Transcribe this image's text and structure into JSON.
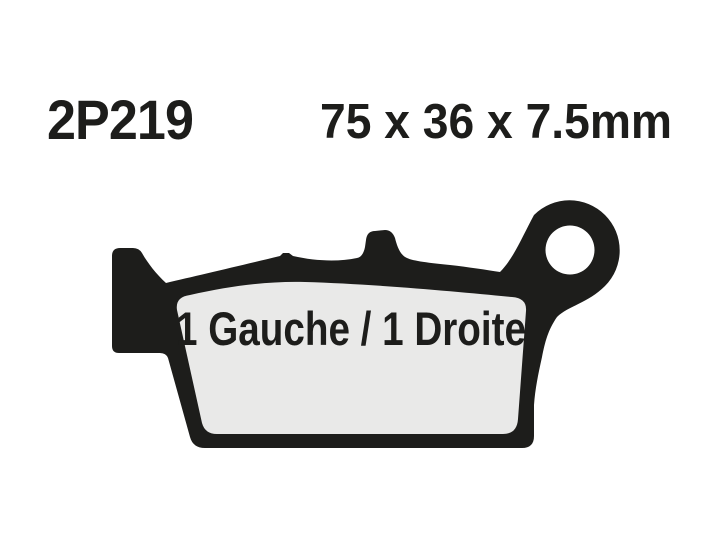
{
  "page": {
    "background_color": "#ffffff"
  },
  "header": {
    "part_number": "2P219",
    "dimensions": "75 x 36 x 7.5mm"
  },
  "diagram": {
    "orientation_label": "1 Gauche / 1 Droite",
    "colors": {
      "silhouette": "#1d1d1b",
      "friction_pad": "#e9e9e8",
      "hole": "#ffffff"
    }
  }
}
